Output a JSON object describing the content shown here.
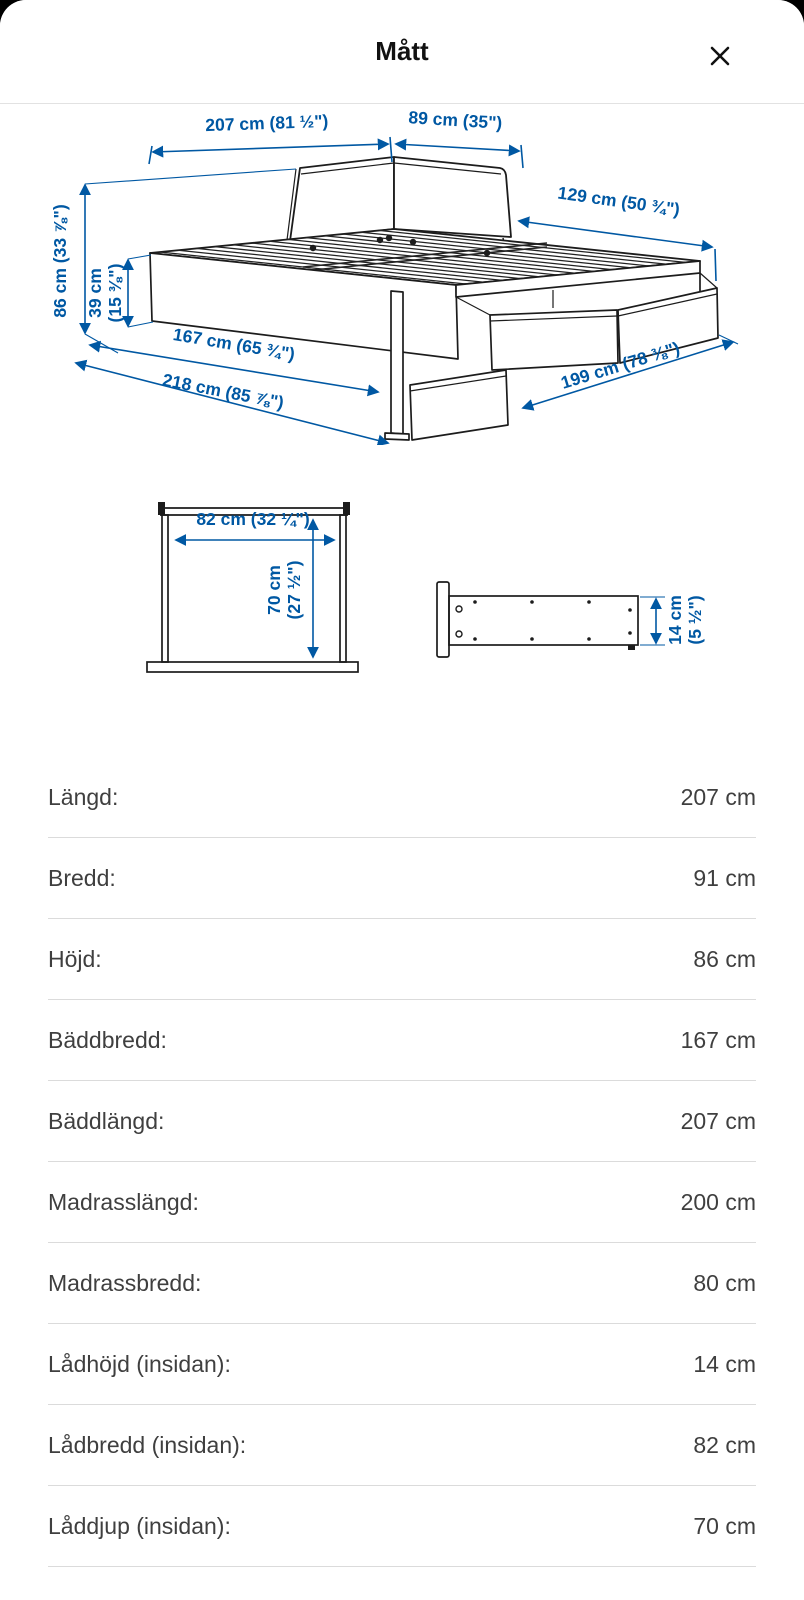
{
  "header": {
    "title": "Mått"
  },
  "colors": {
    "dimension_blue": "#0058a3",
    "line_color": "#1c1c1c",
    "text_gray": "#3f3f3f"
  },
  "bed_diagram": {
    "d207": "207 cm (81 ½\")",
    "d89": "89 cm (35\")",
    "d129": "129 cm (50 ¾\")",
    "d86": "86 cm (33 ⅞\")",
    "d39_l1": "39 cm",
    "d39_l2": "(15 ⅜\")",
    "d167": "167 cm (65 ¾\")",
    "d218": "218 cm (85 ⅞\")",
    "d199": "199 cm (78 ⅜\")"
  },
  "drawer_diagram": {
    "d82": "82 cm (32 ¼\")",
    "d70_l1": "70 cm",
    "d70_l2": "(27 ½\")",
    "d14_l1": "14 cm",
    "d14_l2": "(5 ½\")"
  },
  "measurements": [
    {
      "label": "Längd:",
      "value": "207 cm"
    },
    {
      "label": "Bredd:",
      "value": "91 cm"
    },
    {
      "label": "Höjd:",
      "value": "86 cm"
    },
    {
      "label": "Bäddbredd:",
      "value": "167 cm"
    },
    {
      "label": "Bäddlängd:",
      "value": "207 cm"
    },
    {
      "label": "Madrasslängd:",
      "value": "200 cm"
    },
    {
      "label": "Madrassbredd:",
      "value": "80 cm"
    },
    {
      "label": "Lådhöjd (insidan):",
      "value": "14 cm"
    },
    {
      "label": "Lådbredd (insidan):",
      "value": "82 cm"
    },
    {
      "label": "Låddjup (insidan):",
      "value": "70 cm"
    }
  ]
}
